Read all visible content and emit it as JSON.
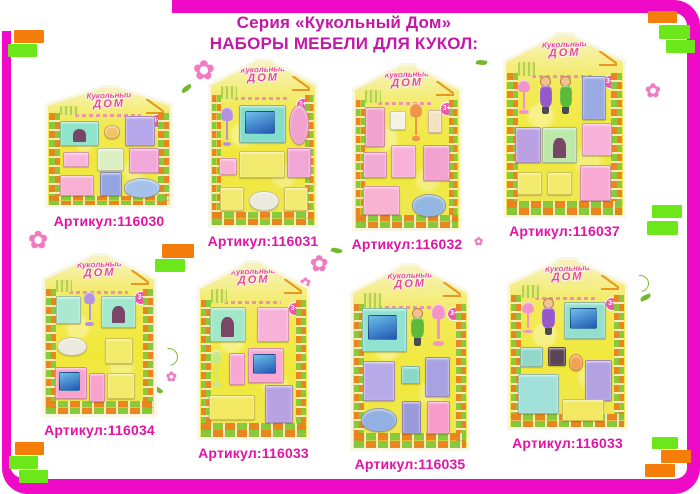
{
  "header": {
    "title_line1": "Серия «Кукольный Дом»",
    "title_line2": "НАБОРЫ МЕБЕЛИ ДЛЯ КУКОЛ:"
  },
  "branding": {
    "logo_line1": "Кукольный",
    "logo_line2": "ДОМ",
    "age_badge": "3+"
  },
  "palette": {
    "frame": "#ee0ac6",
    "accent_orange": "#f57d0a",
    "accent_green": "#6ce81a",
    "title_text": "#c318a6",
    "article_text": "#e214a6",
    "card_yellow": "#f2e93c",
    "brick_orange": "#e8821c",
    "brick_green": "#84c838"
  },
  "icons": {
    "flower": "✿"
  },
  "accent_rects": [
    {
      "x": 14,
      "y": 30,
      "w": 30,
      "h": 13,
      "color": "orange"
    },
    {
      "x": 8,
      "y": 44,
      "w": 29,
      "h": 13,
      "color": "green"
    },
    {
      "x": 648,
      "y": 11,
      "w": 29,
      "h": 12,
      "color": "orange"
    },
    {
      "x": 659,
      "y": 25,
      "w": 31,
      "h": 14,
      "color": "green"
    },
    {
      "x": 666,
      "y": 40,
      "w": 29,
      "h": 13,
      "color": "green"
    },
    {
      "x": 162,
      "y": 244,
      "w": 32,
      "h": 14,
      "color": "orange"
    },
    {
      "x": 155,
      "y": 259,
      "w": 30,
      "h": 13,
      "color": "green"
    },
    {
      "x": 652,
      "y": 205,
      "w": 30,
      "h": 13,
      "color": "green"
    },
    {
      "x": 647,
      "y": 221,
      "w": 31,
      "h": 14,
      "color": "green"
    },
    {
      "x": 15,
      "y": 442,
      "w": 29,
      "h": 13,
      "color": "orange"
    },
    {
      "x": 9,
      "y": 456,
      "w": 29,
      "h": 13,
      "color": "green"
    },
    {
      "x": 19,
      "y": 470,
      "w": 29,
      "h": 13,
      "color": "green"
    },
    {
      "x": 652,
      "y": 437,
      "w": 26,
      "h": 12,
      "color": "green"
    },
    {
      "x": 661,
      "y": 450,
      "w": 30,
      "h": 13,
      "color": "orange"
    },
    {
      "x": 645,
      "y": 464,
      "w": 30,
      "h": 13,
      "color": "orange"
    }
  ],
  "flowers": [
    {
      "type": "flower",
      "x": 193,
      "y": 58,
      "size": 26
    },
    {
      "type": "flower",
      "x": 215,
      "y": 78,
      "size": 14
    },
    {
      "type": "leaf",
      "x": 181,
      "y": 86,
      "r": -30
    },
    {
      "type": "flower",
      "x": 28,
      "y": 228,
      "size": 24
    },
    {
      "type": "flower",
      "x": 310,
      "y": 254,
      "size": 22
    },
    {
      "type": "flower",
      "x": 300,
      "y": 277,
      "size": 13
    },
    {
      "type": "leaf",
      "x": 331,
      "y": 248,
      "r": 20
    },
    {
      "type": "flower",
      "x": 645,
      "y": 82,
      "size": 19
    },
    {
      "type": "swirl",
      "x": 160,
      "y": 348,
      "size": 16
    },
    {
      "type": "flower",
      "x": 166,
      "y": 371,
      "size": 13
    },
    {
      "type": "leaf",
      "x": 152,
      "y": 387,
      "r": 40
    },
    {
      "type": "swirl",
      "x": 632,
      "y": 275,
      "size": 15
    },
    {
      "type": "leaf",
      "x": 640,
      "y": 295,
      "r": -20
    },
    {
      "type": "leaf",
      "x": 476,
      "y": 60,
      "r": 10
    },
    {
      "type": "flower",
      "x": 474,
      "y": 236,
      "size": 11
    }
  ],
  "cards": [
    {
      "article": "Артикул:116030",
      "x": 45,
      "y": 85,
      "w": 128,
      "h": 123,
      "items": [
        {
          "name": "fireplace",
          "kind": "fireplace",
          "color": "#8de4ca",
          "x": 10,
          "y": 28,
          "w": 30,
          "h": 20
        },
        {
          "name": "cup",
          "kind": "oval",
          "color": "#f2c468",
          "x": 46,
          "y": 32,
          "w": 11,
          "h": 10
        },
        {
          "name": "washstand",
          "color": "#b6a6ea",
          "x": 63,
          "y": 24,
          "w": 23,
          "h": 24
        },
        {
          "name": "radio",
          "color": "#f8b6da",
          "x": 12,
          "y": 55,
          "w": 20,
          "h": 11
        },
        {
          "name": "table",
          "color": "#dcefc4",
          "x": 40,
          "y": 51,
          "w": 21,
          "h": 18
        },
        {
          "name": "piano",
          "color": "#f2a8da",
          "x": 66,
          "y": 51,
          "w": 23,
          "h": 20
        },
        {
          "name": "desk",
          "color": "#f8b0d2",
          "x": 10,
          "y": 74,
          "w": 26,
          "h": 17
        },
        {
          "name": "toilet",
          "color": "#94a4e0",
          "x": 43,
          "y": 72,
          "w": 16,
          "h": 19
        },
        {
          "name": "bathtub",
          "kind": "oval",
          "color": "#a6c2ea",
          "x": 62,
          "y": 77,
          "w": 28,
          "h": 15
        }
      ]
    },
    {
      "article": "Артикул:116031",
      "x": 208,
      "y": 58,
      "w": 110,
      "h": 170,
      "items": [
        {
          "name": "floor-lamp",
          "kind": "lamp",
          "color": "#b493de",
          "x": 9,
          "y": 28,
          "w": 13,
          "h": 24
        },
        {
          "name": "tv",
          "kind": "tv",
          "color": "#84dcca",
          "x": 27,
          "y": 27,
          "w": 43,
          "h": 22
        },
        {
          "name": "mirror",
          "kind": "oval",
          "color": "#f2a2ce",
          "x": 75,
          "y": 27,
          "w": 17,
          "h": 23
        },
        {
          "name": "radio",
          "color": "#f8b2d2",
          "x": 8,
          "y": 59,
          "w": 15,
          "h": 9
        },
        {
          "name": "sofa",
          "color": "#f2ea6e",
          "x": 27,
          "y": 55,
          "w": 42,
          "h": 15
        },
        {
          "name": "piano",
          "color": "#f2a6d6",
          "x": 73,
          "y": 53,
          "w": 21,
          "h": 17
        },
        {
          "name": "armchair",
          "color": "#f2ea6e",
          "x": 9,
          "y": 77,
          "w": 21,
          "h": 13
        },
        {
          "name": "bath-rug",
          "kind": "oval",
          "color": "#eceade",
          "x": 37,
          "y": 79,
          "w": 26,
          "h": 11
        },
        {
          "name": "armchair",
          "color": "#f2ea6e",
          "x": 70,
          "y": 77,
          "w": 21,
          "h": 13
        }
      ]
    },
    {
      "article": "Артикул:116032",
      "x": 352,
      "y": 63,
      "w": 110,
      "h": 168,
      "items": [
        {
          "name": "mirror-stand",
          "color": "#f2a2ce",
          "x": 10,
          "y": 25,
          "w": 17,
          "h": 24
        },
        {
          "name": "tissue-box",
          "color": "#f4f2e2",
          "x": 34,
          "y": 28,
          "w": 13,
          "h": 10
        },
        {
          "name": "floor-lamp",
          "kind": "lamp",
          "color": "#f09448",
          "x": 52,
          "y": 23,
          "w": 13,
          "h": 23
        },
        {
          "name": "chair",
          "color": "#f2e2c2",
          "x": 70,
          "y": 27,
          "w": 12,
          "h": 13
        },
        {
          "name": "dresser",
          "color": "#f2aad6",
          "x": 8,
          "y": 53,
          "w": 21,
          "h": 15
        },
        {
          "name": "vanity",
          "color": "#f8b2da",
          "x": 35,
          "y": 49,
          "w": 22,
          "h": 19
        },
        {
          "name": "wardrobe",
          "color": "#f2a2ce",
          "x": 65,
          "y": 49,
          "w": 24,
          "h": 21
        },
        {
          "name": "bed",
          "color": "#f8b2d2",
          "x": 8,
          "y": 74,
          "w": 33,
          "h": 17
        },
        {
          "name": "bathtub",
          "kind": "oval",
          "color": "#92b8e2",
          "x": 55,
          "y": 79,
          "w": 31,
          "h": 13
        }
      ]
    },
    {
      "article": "Артикул:116037",
      "x": 503,
      "y": 32,
      "w": 123,
      "h": 186,
      "items": [
        {
          "name": "floor-lamp",
          "kind": "lamp",
          "color": "#f294ca",
          "x": 9,
          "y": 25,
          "w": 13,
          "h": 19
        },
        {
          "name": "doll-girl",
          "kind": "doll",
          "color": "#9658ca",
          "x": 28,
          "y": 23,
          "w": 12,
          "h": 21
        },
        {
          "name": "doll-boy",
          "kind": "doll",
          "color": "#5cba3a",
          "x": 45,
          "y": 23,
          "w": 12,
          "h": 21
        },
        {
          "name": "fridge",
          "color": "#9aaae2",
          "x": 65,
          "y": 23,
          "w": 19,
          "h": 23
        },
        {
          "name": "vanity",
          "color": "#baa2e2",
          "x": 8,
          "y": 51,
          "w": 20,
          "h": 19
        },
        {
          "name": "fireplace",
          "kind": "fireplace",
          "color": "#bce8aa",
          "x": 31,
          "y": 51,
          "w": 28,
          "h": 19
        },
        {
          "name": "piano",
          "color": "#f8b2da",
          "x": 65,
          "y": 49,
          "w": 24,
          "h": 17
        },
        {
          "name": "armchair",
          "color": "#f2ea6a",
          "x": 9,
          "y": 76,
          "w": 20,
          "h": 12
        },
        {
          "name": "armchair",
          "color": "#f2ea6a",
          "x": 35,
          "y": 76,
          "w": 20,
          "h": 12
        },
        {
          "name": "desk",
          "color": "#f8aad2",
          "x": 63,
          "y": 72,
          "w": 25,
          "h": 19
        }
      ]
    },
    {
      "article": "Артикул:116034",
      "x": 42,
      "y": 253,
      "w": 115,
      "h": 164,
      "items": [
        {
          "name": "chair",
          "color": "#aae8d2",
          "x": 10,
          "y": 25,
          "w": 21,
          "h": 17
        },
        {
          "name": "floor-lamp",
          "kind": "lamp",
          "color": "#b493de",
          "x": 35,
          "y": 23,
          "w": 12,
          "h": 21
        },
        {
          "name": "fireplace",
          "kind": "fireplace",
          "color": "#a2e8cc",
          "x": 51,
          "y": 25,
          "w": 31,
          "h": 19
        },
        {
          "name": "mirror",
          "kind": "oval",
          "color": "#eceade",
          "x": 11,
          "y": 51,
          "w": 26,
          "h": 11
        },
        {
          "name": "armchair",
          "color": "#f2ea6a",
          "x": 55,
          "y": 52,
          "w": 24,
          "h": 15
        },
        {
          "name": "desk-tv",
          "kind": "tv",
          "color": "#f8a2ce",
          "x": 9,
          "y": 70,
          "w": 28,
          "h": 19
        },
        {
          "name": "chair-pink",
          "color": "#f8a2ce",
          "x": 40,
          "y": 74,
          "w": 13,
          "h": 17
        },
        {
          "name": "armchair",
          "color": "#f2ea6a",
          "x": 57,
          "y": 74,
          "w": 24,
          "h": 15
        }
      ]
    },
    {
      "article": "Артикул:116033",
      "x": 197,
      "y": 260,
      "w": 113,
      "h": 180,
      "items": [
        {
          "name": "fireplace",
          "kind": "fireplace",
          "color": "#a2e8c8",
          "x": 9,
          "y": 25,
          "w": 32,
          "h": 19
        },
        {
          "name": "piano",
          "color": "#f8b2da",
          "x": 53,
          "y": 25,
          "w": 28,
          "h": 19
        },
        {
          "name": "floor-lamp",
          "kind": "lamp",
          "color": "#cce884",
          "x": 9,
          "y": 50,
          "w": 13,
          "h": 21
        },
        {
          "name": "chair",
          "color": "#f8a8d2",
          "x": 27,
          "y": 52,
          "w": 13,
          "h": 17
        },
        {
          "name": "desk-tv",
          "kind": "tv",
          "color": "#f8a8d2",
          "x": 45,
          "y": 49,
          "w": 32,
          "h": 19
        },
        {
          "name": "sofa",
          "color": "#f2e862",
          "x": 8,
          "y": 76,
          "w": 42,
          "h": 13
        },
        {
          "name": "wardrobe",
          "color": "#b8a2e2",
          "x": 61,
          "y": 70,
          "w": 24,
          "h": 21
        }
      ]
    },
    {
      "article": "Артикул:116035",
      "x": 350,
      "y": 263,
      "w": 120,
      "h": 188,
      "items": [
        {
          "name": "tv",
          "kind": "tv",
          "color": "#92e2d2",
          "x": 8,
          "y": 23,
          "w": 38,
          "h": 23
        },
        {
          "name": "doll-boy",
          "kind": "doll",
          "color": "#5cba3a",
          "x": 50,
          "y": 23,
          "w": 13,
          "h": 21
        },
        {
          "name": "floor-lamp",
          "kind": "lamp",
          "color": "#f294ca",
          "x": 68,
          "y": 21,
          "w": 14,
          "h": 23
        },
        {
          "name": "wardrobe",
          "color": "#b8aae8",
          "x": 9,
          "y": 52,
          "w": 26,
          "h": 21
        },
        {
          "name": "radio",
          "color": "#8ad8ca",
          "x": 42,
          "y": 55,
          "w": 15,
          "h": 9
        },
        {
          "name": "vanity",
          "color": "#a8a2e2",
          "x": 63,
          "y": 50,
          "w": 20,
          "h": 21
        },
        {
          "name": "bathtub",
          "kind": "oval",
          "color": "#92b0e2",
          "x": 7,
          "y": 78,
          "w": 30,
          "h": 12
        },
        {
          "name": "toilet",
          "color": "#9a9ada",
          "x": 43,
          "y": 74,
          "w": 15,
          "h": 17
        },
        {
          "name": "mirror",
          "color": "#f89aca",
          "x": 65,
          "y": 74,
          "w": 18,
          "h": 17
        }
      ]
    },
    {
      "article": "Артикул:116033",
      "x": 507,
      "y": 257,
      "w": 121,
      "h": 173,
      "items": [
        {
          "name": "floor-lamp",
          "kind": "lamp",
          "color": "#f294ca",
          "x": 9,
          "y": 25,
          "w": 13,
          "h": 19
        },
        {
          "name": "doll-girl",
          "kind": "doll",
          "color": "#9658ca",
          "x": 27,
          "y": 23,
          "w": 13,
          "h": 22
        },
        {
          "name": "tv",
          "kind": "tv",
          "color": "#92e0cc",
          "x": 47,
          "y": 25,
          "w": 35,
          "h": 21
        },
        {
          "name": "radio",
          "color": "#92d8ca",
          "x": 9,
          "y": 52,
          "w": 18,
          "h": 11
        },
        {
          "name": "camera",
          "color": "#5a4456",
          "x": 33,
          "y": 52,
          "w": 14,
          "h": 10
        },
        {
          "name": "accessory",
          "kind": "oval",
          "color": "#f2a252",
          "x": 51,
          "y": 56,
          "w": 11,
          "h": 9
        },
        {
          "name": "dining-table",
          "color": "#a2e0da",
          "x": 7,
          "y": 68,
          "w": 34,
          "h": 23
        },
        {
          "name": "wardrobe",
          "color": "#b2a2e2",
          "x": 65,
          "y": 60,
          "w": 22,
          "h": 23
        },
        {
          "name": "sofa",
          "color": "#f2e862",
          "x": 45,
          "y": 83,
          "w": 35,
          "h": 12
        }
      ]
    }
  ]
}
